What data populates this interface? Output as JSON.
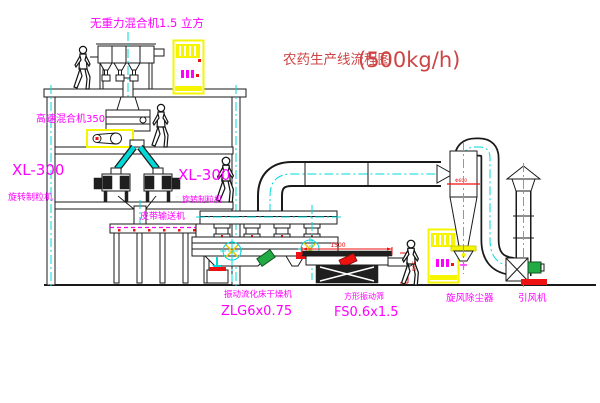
{
  "title": {
    "text": "农药生产线流程图",
    "capacity": "(500kg/h)"
  },
  "labels": {
    "gravity_mixer": "无重力混合机1.5 立方",
    "high_speed_mixer": "高速混合机350",
    "granulator_left_model": "XL-300",
    "granulator_left_name": "旋转制粒机",
    "granulator_right_model": "XL-300",
    "granulator_right_name": "旋转制粒机",
    "belt_conveyor": "皮带输送机",
    "dryer_name": "振动流化床干燥机",
    "dryer_model": "ZLG6x0.75",
    "sieve_name": "方形振动筛",
    "sieve_model": "FS0.6x1.5",
    "cyclone_name": "旋风除尘器",
    "fan_name": "引风机"
  },
  "dimensions": {
    "sieve_length": "1500",
    "sieve_height": "545",
    "cyclone_diameter": "Φ600"
  },
  "colors": {
    "label_magenta": "#ff00ff",
    "title_red": "#cc4444",
    "dimension_red": "#ee1111",
    "centerline_cyan": "#00d8d8",
    "cabinet_yellow": "#f5f500",
    "motor_green": "#22aa44",
    "line_black": "#1a1a1a",
    "background": "#ffffff"
  }
}
